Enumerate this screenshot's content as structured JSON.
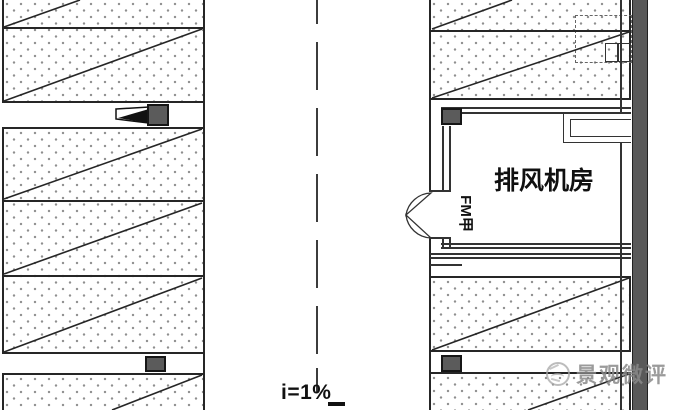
{
  "labels": {
    "fan_room": "排风机房",
    "fire_door": "FM甲",
    "slope": "i=1%"
  },
  "watermark": {
    "text": "景观微评"
  },
  "colors": {
    "line": "#262626",
    "wall_fill": "#5b5b5b",
    "equipment_fill": "#5b5b5b",
    "stall_dot": "#8f8f8f",
    "watermark_gray": "#8a8a8a"
  },
  "icons": {
    "jet_fan": "jet-fan-icon",
    "equipment_box": "equipment-box-icon",
    "double_door": "double-swing-door-icon",
    "watermark_logo": "watermark-logo-icon"
  }
}
